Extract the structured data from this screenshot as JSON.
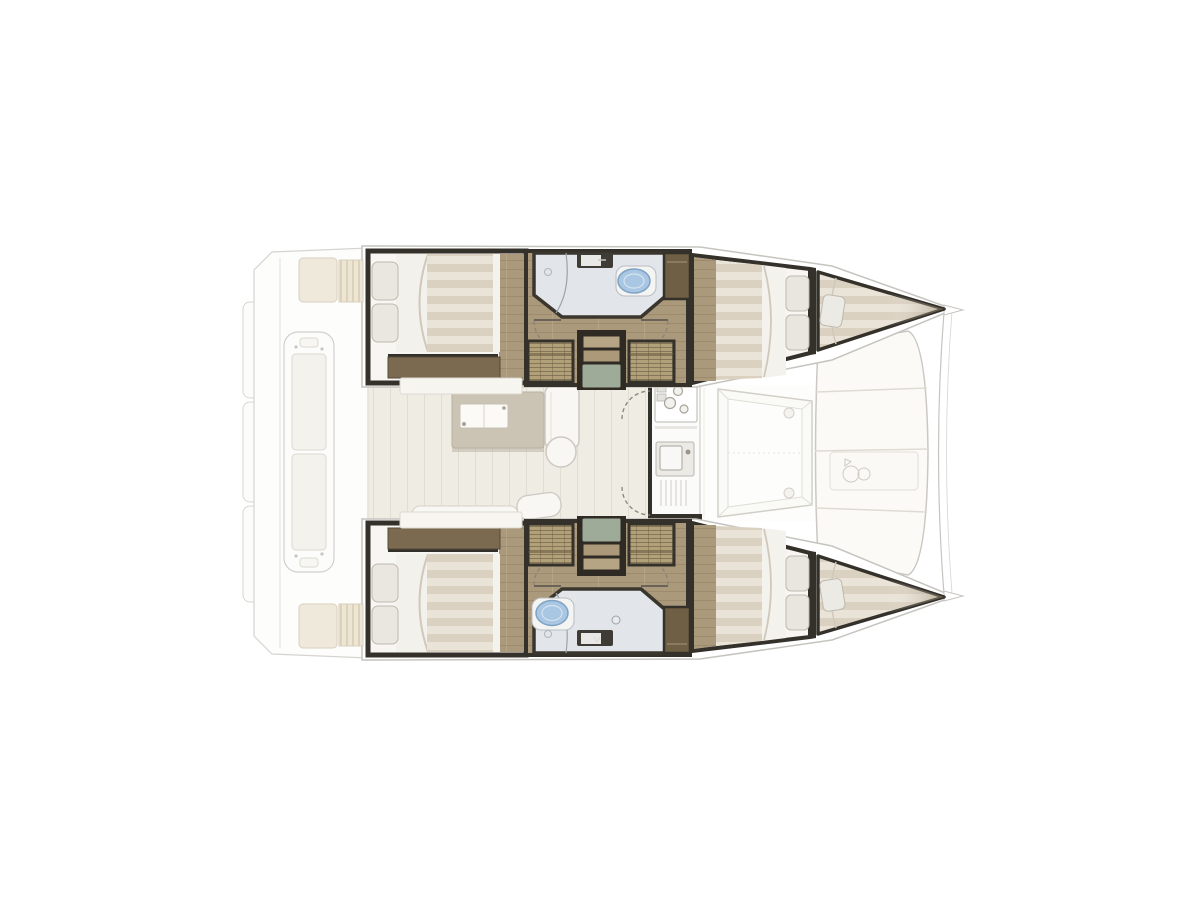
{
  "window": {
    "background": "#ffffff",
    "description": "catamaran-interior-floor-plan, top-down view, bow facing right"
  },
  "diagram": {
    "type": "floor-plan",
    "vessel": "catamaran",
    "orientation": "bow-right",
    "rooms": [
      {
        "id": "aft-cockpit",
        "label": "aft cockpit with transom bench and swim platforms"
      },
      {
        "id": "salon",
        "label": "salon with dining table, chaise sofa and galley"
      },
      {
        "id": "aft-cabin-port",
        "label": "aft double cabin, port hull"
      },
      {
        "id": "bathroom-port",
        "label": "shower room with toilet and sink, port hull"
      },
      {
        "id": "forward-cabin-port",
        "label": "forward double cabin, port hull"
      },
      {
        "id": "forepeak-berth-port",
        "label": "bow single berth, port hull"
      },
      {
        "id": "aft-cabin-starboard",
        "label": "aft double cabin, starboard hull"
      },
      {
        "id": "bathroom-starboard",
        "label": "shower room with toilet and sink, starboard hull"
      },
      {
        "id": "forward-cabin-starboard",
        "label": "forward double cabin, starboard hull"
      },
      {
        "id": "forepeak-berth-starboard",
        "label": "bow single berth, starboard hull"
      },
      {
        "id": "forward-cockpit",
        "label": "forward cockpit lounge seat"
      },
      {
        "id": "bow-lounge",
        "label": "segmented bow sunpad between hulls"
      }
    ],
    "features": [
      "double-bed x4",
      "single-berth x2",
      "pillows",
      "toilet x2",
      "sink x2",
      "shower x2",
      "companionway-stairs x2",
      "wicker-wardrobe x4",
      "door-swing-arcs",
      "dining-table",
      "chaise-sofa",
      "galley-stove",
      "galley-sink-drainboard",
      "cockpit-bench",
      "cockpit-cushions",
      "sunpad-panels",
      "bowsprit-curves"
    ],
    "colors": {
      "background": "#ffffff",
      "bulkhead": "#34302a",
      "wood_floor": "#ab997b",
      "mattress_light": "#eae3d7",
      "mattress_dark": "#dbd1c1",
      "pillow": "#eae7e0",
      "wicker": "#b2a078",
      "sideboard": "#7b6a4f",
      "cabinet_brown": "#6e5f45",
      "bath_floor": "#e2e6ea",
      "toilet": "#a9c6e2",
      "stair_pad": "#9dab98",
      "table": "#cbc3b4",
      "salon_floor": "#efece4",
      "deck_white": "#fbfaf7",
      "outline_faint": "#cfccc6"
    }
  }
}
